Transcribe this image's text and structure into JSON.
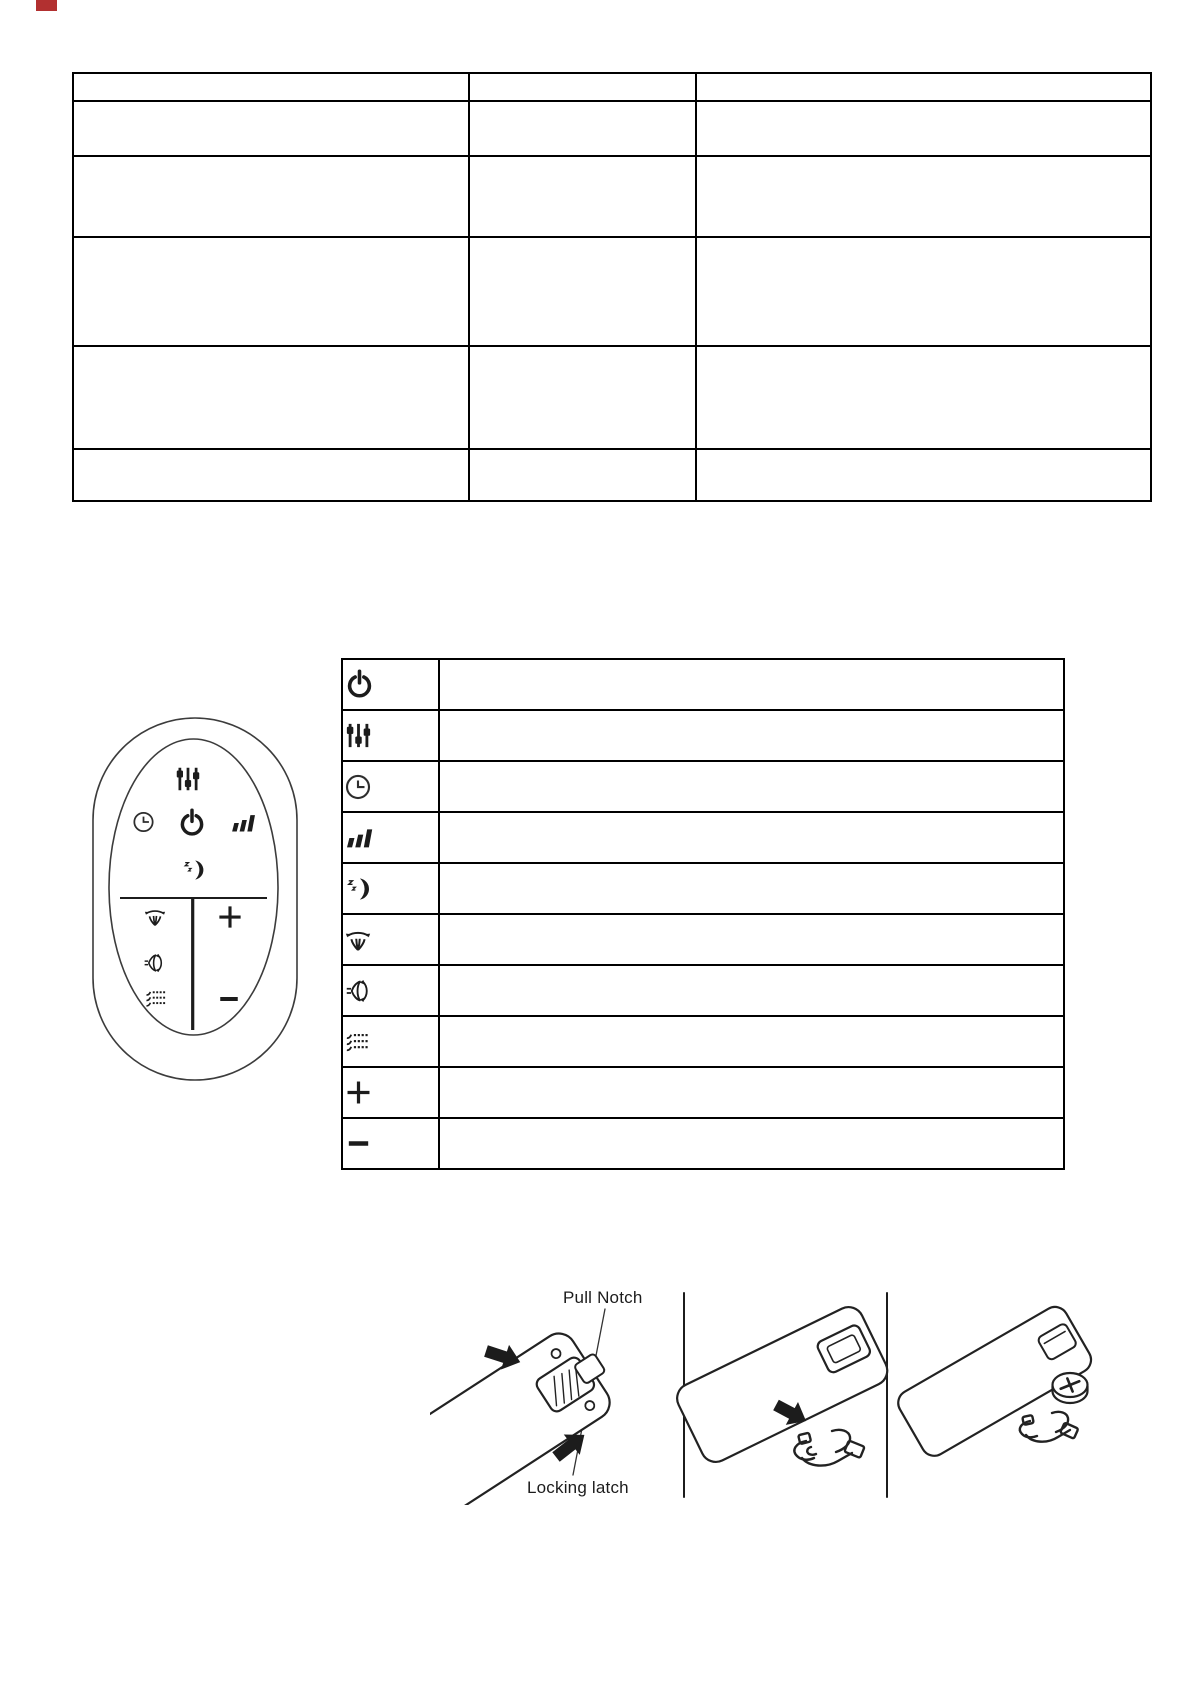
{
  "page": {
    "type": "manual-page",
    "background": "#ffffff"
  },
  "colors": {
    "line_art": "#1c1c1c",
    "table_border": "#000000",
    "background": "#ffffff",
    "scan_artifact_red": "#b23030"
  },
  "spec_table": {
    "note": "empty bordered table, 3 columns x 6 rows, no visible text",
    "cells": [
      [
        "",
        "",
        ""
      ],
      [
        "",
        "",
        ""
      ],
      [
        "",
        "",
        ""
      ],
      [
        "",
        "",
        ""
      ],
      [
        "",
        "",
        ""
      ],
      [
        "",
        "",
        ""
      ]
    ]
  },
  "remote_figure": {
    "name": "remote-control-drawing",
    "buttons": [
      "settings-sliders",
      "timer-clock",
      "power",
      "fan-speed",
      "sleep-mode",
      "oscillation",
      "plus",
      "airflow-direction",
      "mist-spray",
      "minus"
    ]
  },
  "icons": {
    "power-icon": "sym-power",
    "settings-sliders-icon": "sym-sliders",
    "timer-clock-icon": "sym-clock",
    "fan-speed-icon": "sym-fanspeed",
    "sleep-mode-icon": "sym-moon",
    "oscillation-icon": "sym-oscillate",
    "airflow-direction-icon": "sym-airflow",
    "mist-spray-icon": "sym-mist",
    "plus-icon": "sym-plus",
    "minus-icon": "sym-minus"
  },
  "icon_table": {
    "note": "legend table, icon column + empty description column",
    "rows": [
      {
        "icon": "power-icon",
        "description": ""
      },
      {
        "icon": "settings-sliders-icon",
        "description": ""
      },
      {
        "icon": "timer-clock-icon",
        "description": ""
      },
      {
        "icon": "fan-speed-icon",
        "description": ""
      },
      {
        "icon": "sleep-mode-icon",
        "description": ""
      },
      {
        "icon": "oscillation-icon",
        "description": ""
      },
      {
        "icon": "airflow-direction-icon",
        "description": ""
      },
      {
        "icon": "mist-spray-icon",
        "description": ""
      },
      {
        "icon": "plus-icon",
        "description": ""
      },
      {
        "icon": "minus-icon",
        "description": ""
      }
    ]
  },
  "battery_figure": {
    "labels": {
      "pull_notch": "Pull Notch",
      "locking_latch": "Locking latch"
    },
    "panels": [
      "press latch at pull notch",
      "slide battery holder out",
      "remote back with coin cell and holder"
    ]
  }
}
